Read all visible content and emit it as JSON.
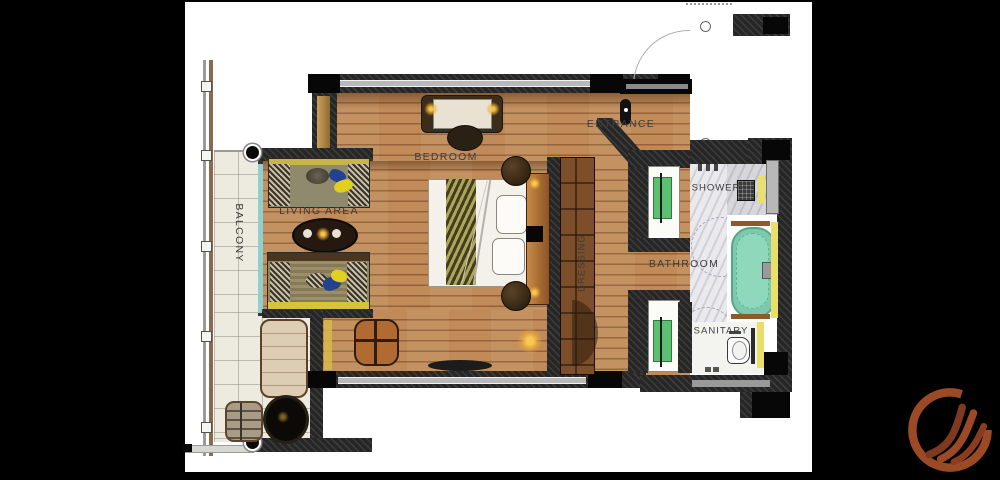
{
  "title": "hotel suite floor plan",
  "rooms": [
    {
      "id": "balcony",
      "label": "BALCONY"
    },
    {
      "id": "living-area",
      "label": "LIVING AREA"
    },
    {
      "id": "bedroom",
      "label": "BEDROOM"
    },
    {
      "id": "entrance",
      "label": "ENTRANCE"
    },
    {
      "id": "dressing",
      "label": "DRESSING"
    },
    {
      "id": "bathroom",
      "label": "BATHROOM"
    },
    {
      "id": "shower",
      "label": "SHOWER"
    },
    {
      "id": "sanitary",
      "label": "SANITARY"
    }
  ],
  "fixtures": [
    "double-bed",
    "desk",
    "desk-chair",
    "nightstand",
    "sofa",
    "coffee-table",
    "armchair",
    "sun-lounger",
    "side-table",
    "basket-chair",
    "wardrobe",
    "vanity-sink",
    "bathtub",
    "shower-fixture",
    "toilet",
    "bench",
    "balcony-railing",
    "entrance-door"
  ],
  "colors": {
    "background": "#000000",
    "paper": "#ffffff",
    "wall": "#262626",
    "wood_floor": "#c18b59",
    "balcony_tile": "#edebdf",
    "marble": "#eaeaee",
    "bathtub_teal": "#7cc9ad",
    "vanity_green": "#5cbf72",
    "accent_yellow": "#e8e06a",
    "sofa_yellow": "#d6c33a",
    "pillow_blue": "#23418e",
    "glass_teal": "#8fd0cf",
    "label_text": "#3c3c3c",
    "logo_rust": "#9c4a26"
  },
  "logo": {
    "name": "flame-crest-logo"
  }
}
